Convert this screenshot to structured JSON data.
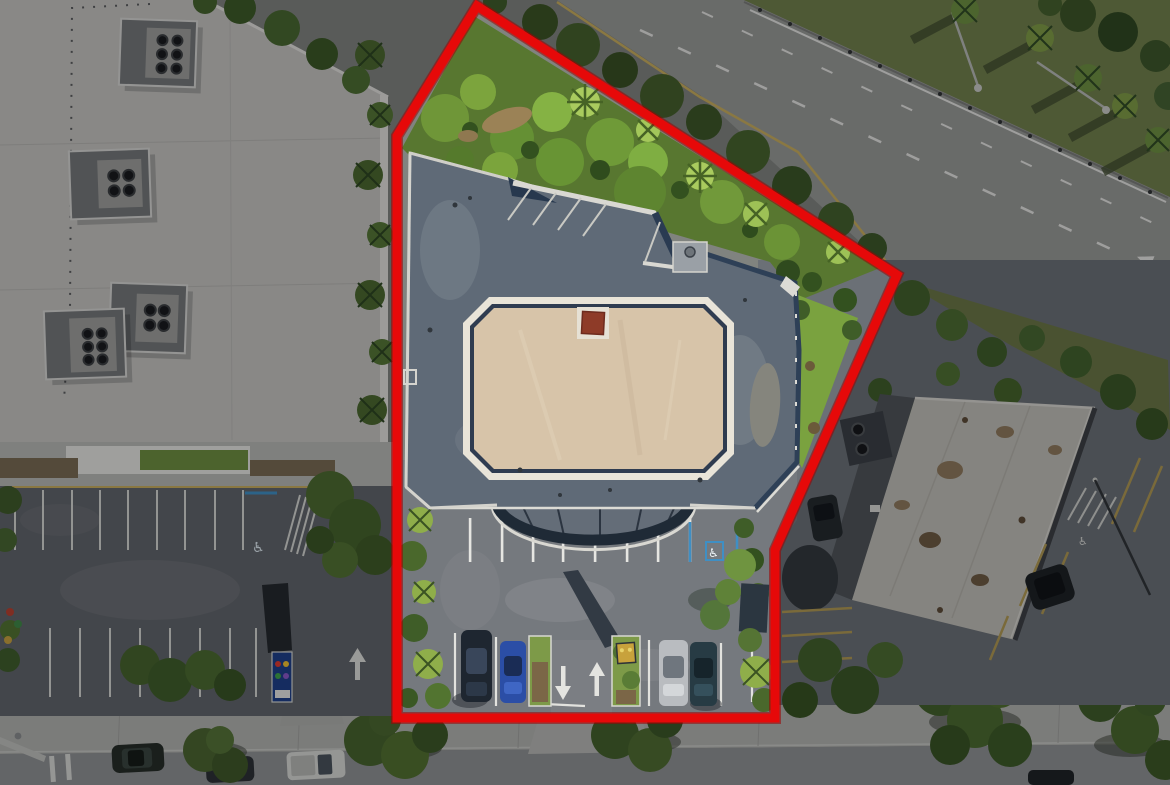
{
  "image": {
    "width": 1170,
    "height": 785,
    "aria_label": "Aerial drone photo of a one-story commercial building with parking, outlined by a red property boundary line; surrounding roads, parking lots, neighboring buildings and trees are dimmed"
  },
  "boundary": {
    "points": "477,6 897,275 775,550 775,718 397,718 397,136",
    "color": "#e60909",
    "underlay_color": "#9e0202",
    "stroke_width": 9
  },
  "colors": {
    "backdrop": "#80837f",
    "dim_overlay": "#05070a",
    "subject_roof": "#5f6a77",
    "subject_roof_center_tan": "#d7c4a9",
    "parapet_white": "#dcdbd5",
    "roof_hatch_red": "#8e3b28",
    "property_asphalt": "#75797e",
    "left_neighbor_roof": "#c7c6c2",
    "right_neighbor_roof": "#c2c0b8",
    "road": "#999b97",
    "sidewalk": "#b3b4b0",
    "street": "#909294",
    "grass_median": "#71804a",
    "lawn_green": "#7aa23f",
    "tree_dark_green": "#3d5a26",
    "tree_bright_green": "#7ca43d",
    "stripe_white": "#e2e2de",
    "stripe_yellow": "#c9ae5e",
    "handicap_blue": "#3f8fc4"
  },
  "symbols": {
    "wheelchair": "♿"
  }
}
